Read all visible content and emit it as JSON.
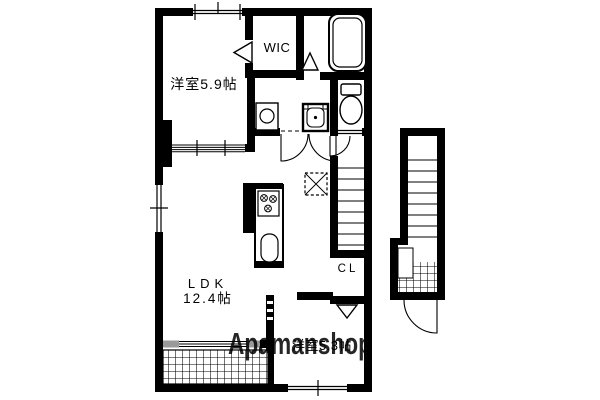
{
  "plan": {
    "type": "apartment-floor-plan",
    "rooms": {
      "bedroom1": {
        "label": "洋室5.9帖"
      },
      "wic": {
        "label": "WIC"
      },
      "ldk": {
        "line1": "LDK",
        "line2": "12.4帖"
      },
      "closet": {
        "label": "CL"
      },
      "bedroom2": {
        "label": "洋室5.3帖"
      }
    },
    "fixtures": [
      "bathtub",
      "toilet",
      "washbasin",
      "washing-machine",
      "kitchen-stove",
      "kitchen-sink",
      "refrigerator",
      "internal-staircase",
      "external-staircase",
      "balcony-hatch",
      "entrance-hatch",
      "entrance-door"
    ],
    "watermark": {
      "text": "Apamanshop",
      "color": "#8e8e8e"
    },
    "colors": {
      "wall": "#000000",
      "background": "#ffffff",
      "accent_gray": "#999999"
    }
  }
}
